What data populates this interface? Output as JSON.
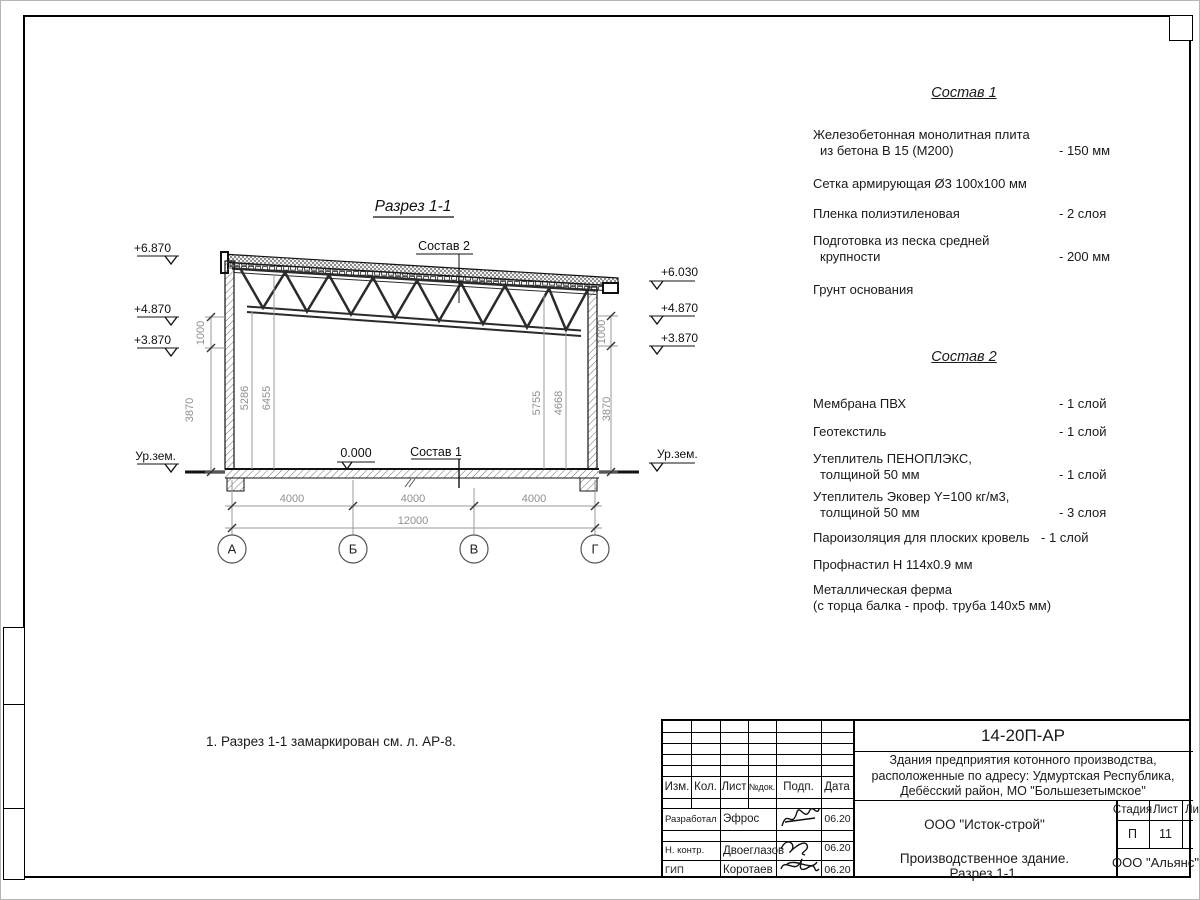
{
  "drawing": {
    "title": "Разрез 1-1",
    "labels": {
      "sostav2": "Состав 2",
      "sostav1": "Состав 1",
      "zero": "0.000",
      "ground_left": "Ур.зем.",
      "ground_right": "Ур.зем."
    },
    "elev_left": [
      "+6.870",
      "+4.870",
      "+3.870"
    ],
    "elev_right": [
      "+6.030",
      "+4.870",
      "+3.870"
    ],
    "dims": {
      "spans": [
        "4000",
        "4000",
        "4000"
      ],
      "total": "12000",
      "left_outer": [
        "1000",
        "3870"
      ],
      "right_outer": [
        "1000",
        "3870"
      ],
      "inner_left": [
        "5286",
        "6455"
      ],
      "inner_right": [
        "5755",
        "4668"
      ]
    },
    "axes": [
      "А",
      "Б",
      "В",
      "Г"
    ]
  },
  "note": "1. Разрез 1-1 замаркирован см. л. АР-8.",
  "sostav1": {
    "title": "Состав 1",
    "items": [
      {
        "lines": [
          "Железобетонная  монолитная плита",
          "из бетона В 15 (М200)"
        ],
        "value": "- 150 мм"
      },
      {
        "lines": [
          "Сетка армирующая Ø3 100х100 мм"
        ],
        "value": ""
      },
      {
        "lines": [
          "Пленка полиэтиленовая"
        ],
        "value": "-  2 слоя"
      },
      {
        "lines": [
          "Подготовка из песка средней",
          "крупности"
        ],
        "value": "- 200 мм"
      },
      {
        "lines": [
          "Грунт основания"
        ],
        "value": ""
      }
    ]
  },
  "sostav2": {
    "title": "Состав 2",
    "items": [
      {
        "lines": [
          "Мембрана ПВХ"
        ],
        "value": "- 1 слой"
      },
      {
        "lines": [
          "Геотекстиль"
        ],
        "value": "- 1 слой"
      },
      {
        "lines": [
          "Утеплитель ПЕНОПЛЭКС,",
          "толщиной 50 мм"
        ],
        "value": "- 1 слой"
      },
      {
        "lines": [
          "Утеплитель Эковер Y=100 кг/м3,",
          "толщиной 50 мм"
        ],
        "value": "- 3 слоя"
      },
      {
        "lines": [
          "Пароизоляция для плоских кровель"
        ],
        "value": "- 1 слой"
      },
      {
        "lines": [
          "Профнастил Н 114х0.9 мм"
        ],
        "value": ""
      },
      {
        "lines": [
          "Металлическая ферма",
          "(с торца балка - проф. труба 140х5 мм)"
        ],
        "value": ""
      }
    ]
  },
  "titleblock": {
    "doc_code": "14-20П-АР",
    "project_lines": [
      "Здания предприятия котонного производства,",
      "расположенные по адресу: Удмуртская Республика,",
      "Дебёсский район, МО \"Большезетымское\""
    ],
    "org": "ООО \"Исток-строй\"",
    "object_lines": [
      "Производственное здание.",
      "Разрез 1-1."
    ],
    "customer": "ООО \"Альянс\"",
    "stage_label": "Стадия",
    "sheet_label": "Лист",
    "sheets_label": "Листов",
    "stage": "П",
    "sheet_no": "11",
    "cols": {
      "izm": "Изм.",
      "kol": "Кол.",
      "list": "Лист",
      "ndok": "№док.",
      "podp": "Подп.",
      "data": "Дата"
    },
    "rows": [
      {
        "role": "Разработал",
        "name": "Эфрос",
        "date": "06.20"
      },
      {
        "role": "Н. контр.",
        "name": "Двоеглазов",
        "date": "06.20"
      },
      {
        "role": "ГИП",
        "name": "Коротаев",
        "date": "06.20"
      }
    ]
  }
}
